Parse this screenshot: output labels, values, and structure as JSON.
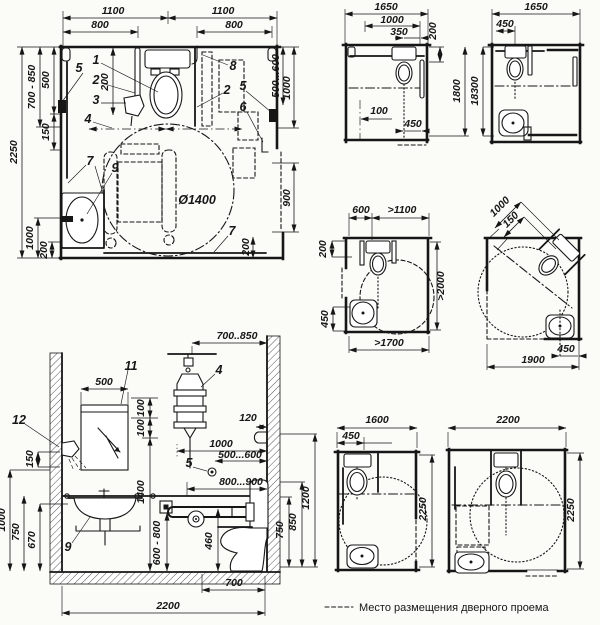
{
  "f1": {
    "d1100a": "1100",
    "d1100b": "1100",
    "d800a": "800",
    "d800b": "800",
    "d2250": "2250",
    "d700_850": "700 - 850",
    "d500": "500",
    "d150": "150",
    "d1000l": "1000",
    "d200l": "200",
    "d500_600": "500...600",
    "d1000r": "1000",
    "d900": "900",
    "d200r": "200",
    "d200t": "200",
    "d1400": "Ø1400",
    "c1": "1",
    "c2": "2",
    "c3": "3",
    "c4": "4",
    "c5a": "5",
    "c5b": "5",
    "c2b": "2",
    "c6": "6",
    "c7a": "7",
    "c7b": "7",
    "c8": "8",
    "c9": "9"
  },
  "f2": {
    "d1650": "1650",
    "d1000": "1000",
    "d350": "350",
    "d200": "200",
    "d1800": "1800",
    "d100": "100",
    "d450": "450"
  },
  "f3": {
    "d1650": "1650",
    "d450": "450",
    "d18300": "18300"
  },
  "f4": {
    "d600": "600",
    "dgt1100": ">1100",
    "d200": "200",
    "dgt2000": ">2000",
    "d450": "450",
    "dgt1700": ">1700"
  },
  "f5": {
    "d1000": "1000",
    "d150": "150",
    "d450": "450",
    "d1900": "1900"
  },
  "f6": {
    "d700_850": "700..850",
    "d500": "500",
    "d100a": "100",
    "d100b": "100",
    "d120": "120",
    "d1000h": "1000",
    "d500_600": "500...600",
    "d800_900": "800...900",
    "d1400": "1400",
    "d600_800": "600 - 800",
    "d460": "460",
    "d150": "150",
    "d1000v": "1000",
    "d750l": "750",
    "d670": "670",
    "d1200": "1200",
    "d850": "850",
    "d750r": "750",
    "d700": "700",
    "d2200": "2200",
    "c4": "4",
    "c5": "5",
    "c9": "9",
    "c11": "11",
    "c12": "12"
  },
  "f7": {
    "d1600": "1600",
    "d450": "450",
    "d2250": "2250"
  },
  "f8": {
    "d2200": "2200",
    "d2250": "2250"
  },
  "legend": {
    "label": "Место размещения дверного проема"
  }
}
